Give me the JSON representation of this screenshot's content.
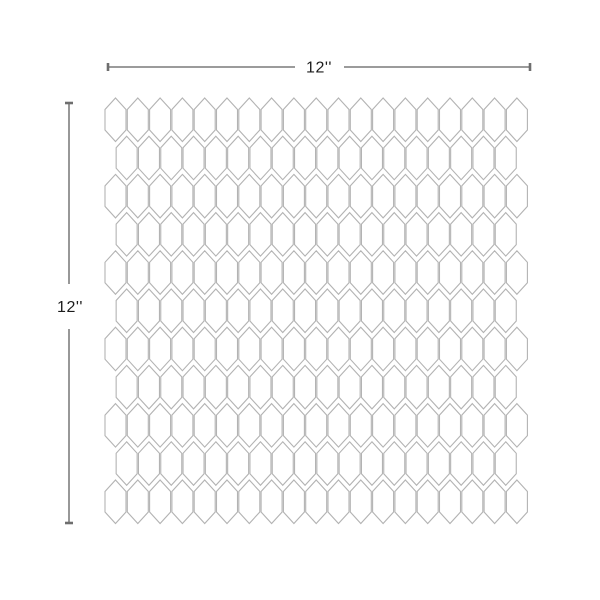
{
  "diagram": {
    "title": "tile-sheet-dimension-diagram",
    "horizontal_dimension": {
      "label": "12''"
    },
    "vertical_dimension": {
      "label": "12''"
    },
    "tile_pattern": {
      "shape": "picket-hexagon",
      "rows": 11,
      "tiles_in_odd_rows": 19,
      "tiles_in_even_rows": 18,
      "outline_color": "#b3b3b3",
      "fill_color": "#ffffff"
    },
    "dimension_line_color": "#8d8d8d",
    "dimension_tick_color": "#6e6e6e",
    "label_color": "#1c1c1c",
    "background_color": "#ffffff"
  }
}
